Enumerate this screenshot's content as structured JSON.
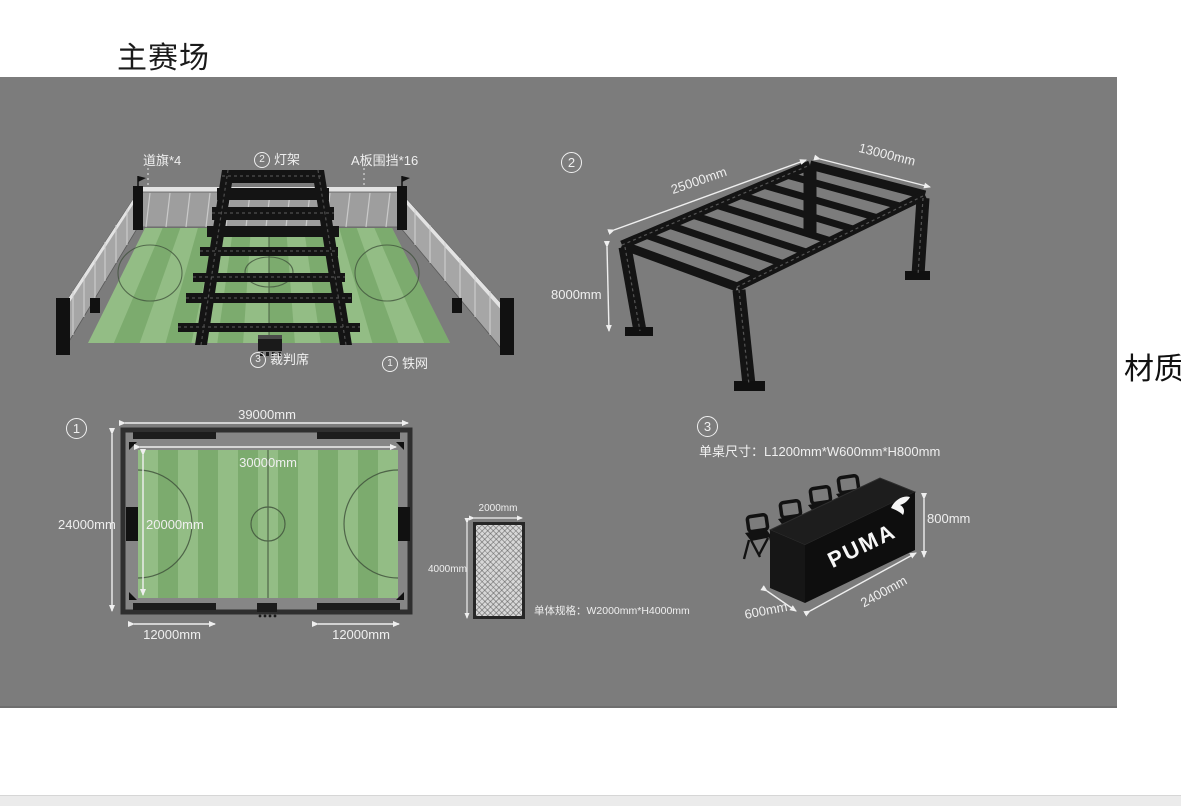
{
  "page": {
    "title": "主赛场",
    "material_label": "材质"
  },
  "colors": {
    "panel_bg": "#7c7c7c",
    "field_light_green": "#93bd85",
    "field_dark_green": "#7cab6e",
    "truss_black": "#141414",
    "dimension_text": "#efefef"
  },
  "stadium_3d": {
    "label_flags": "道旗*4",
    "light_rig_num": "2",
    "light_rig_text": "灯架",
    "label_aboard": "A板围挡*16",
    "referee_num": "3",
    "referee_text": "裁判席",
    "fence_num": "1",
    "fence_text": "铁网"
  },
  "truss_diagram": {
    "num": "2",
    "dim_length": "25000mm",
    "dim_width": "13000mm",
    "dim_height": "8000mm"
  },
  "field_plan": {
    "num": "1",
    "dim_outer_width": "39000mm",
    "dim_inner_width": "30000mm",
    "dim_inner_height": "20000mm",
    "dim_outer_height": "24000mm",
    "dim_gate_left": "12000mm",
    "dim_gate_right": "12000mm"
  },
  "fence_panel": {
    "dim_width": "2000mm",
    "dim_height": "4000mm",
    "spec": "单体规格：W2000mm*H4000mm"
  },
  "table_diagram": {
    "num": "3",
    "spec": "单桌尺寸：L1200mm*W600mm*H800mm",
    "dim_height": "800mm",
    "dim_length": "2400mm",
    "dim_depth": "600mm",
    "brand": "PUMA"
  }
}
